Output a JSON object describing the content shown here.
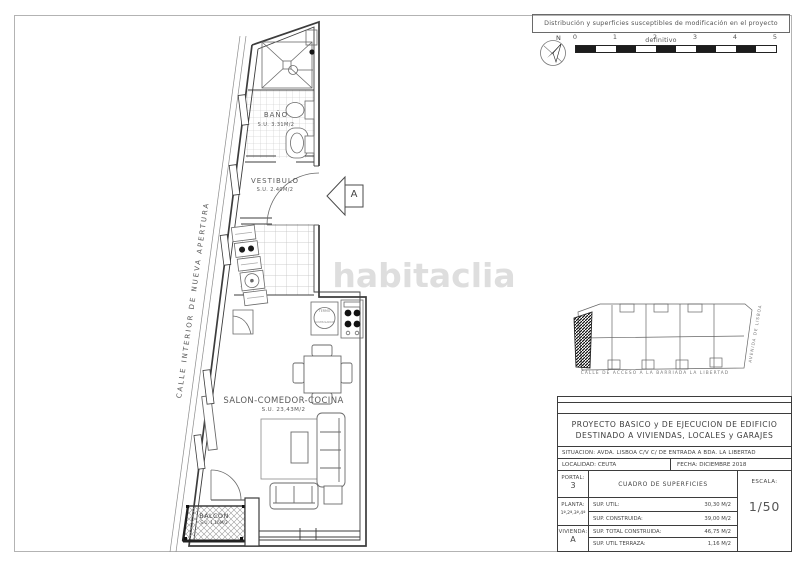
{
  "sheet": {
    "disclaimer": "Distribución y superficies susceptibles de modificación en el proyecto definitivo",
    "compass_north": "N",
    "scale_labels": [
      "0",
      "1",
      "2",
      "3",
      "4",
      "5"
    ],
    "watermark": "habitaclia"
  },
  "plan": {
    "street_left": "CALLE INTERIOR DE NUEVA APERTURA",
    "entrance_marker": "A",
    "rooms": {
      "bano": {
        "name": "BAÑO",
        "area": "S.U. 3.31M/2"
      },
      "vestibulo": {
        "name": "VESTIBULO",
        "area": "S.U. 2.40M/2"
      },
      "salon": {
        "name": "SALON-COMEDOR-COCINA",
        "area": "S.U. 23,43M/2"
      },
      "balcon": {
        "name": "BALCON",
        "area": "S.U. 1,16M/2"
      }
    },
    "fixtures": {
      "water_heater_line1": "TERMO",
      "water_heater_line2": "ACUMULADOR"
    }
  },
  "site_plan": {
    "street_bottom": "CALLE DE ACCESO A LA BARRIADA LA LIBERTAD",
    "street_right": "AVENIDA DE LISBOA"
  },
  "title_block": {
    "project_line1": "PROYECTO BASICO y DE EJECUCION DE EDIFICIO",
    "project_line2": "DESTINADO A VIVIENDAS, LOCALES y GARAJES",
    "situacion": "SITUACION: AVDA. LISBOA C/V C/ DE ENTRADA A BDA. LA LIBERTAD",
    "localidad": "LOCALIDAD: CEUTA",
    "fecha": "FECHA: DICIEMBRE 2018",
    "portal_label": "PORTAL:",
    "portal_value": "3",
    "planta_label": "PLANTA:",
    "planta_value": "1ª,2ª,3ª,4ª",
    "vivienda_label": "VIVIENDA:",
    "vivienda_value": "A",
    "cuadro_title": "CUADRO DE SUPERFICIES",
    "escala_label": "ESCALA:",
    "escala_value": "1/50",
    "rows": [
      {
        "label": "SUP. UTIL:",
        "value": "30,30 M/2"
      },
      {
        "label": "SUP. CONSTRUIDA:",
        "value": "39,00 M/2"
      },
      {
        "label": "SUP. TOTAL CONSTRUIDA:",
        "value": "46,75 M/2"
      },
      {
        "label": "SUP. UTIL TERRAZA:",
        "value": "1,16 M/2"
      }
    ]
  }
}
